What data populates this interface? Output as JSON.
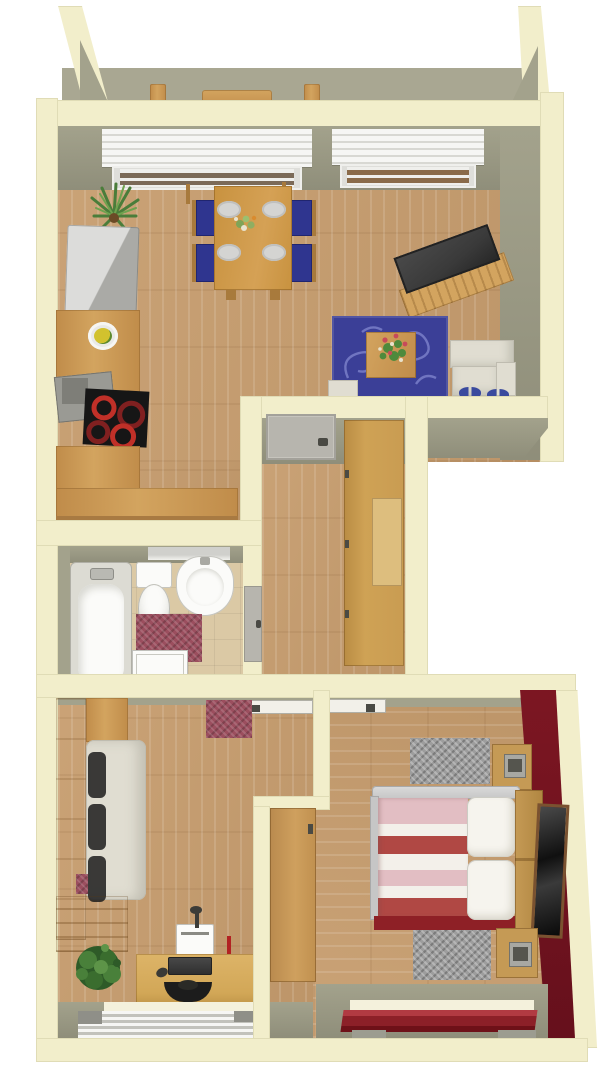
{
  "scene": {
    "type": "3d-floorplan-render",
    "description": "Top-down 3D rendering of a one-bedroom apartment with balcony, open living/dining/kitchen, hallway, bathroom, office room and bedroom",
    "background": "#ffffff"
  },
  "colors": {
    "wall_outer": "#f2eecb",
    "wall_edge": "#d9d3ab",
    "wall_face": "#a3a28c",
    "wall_face_dark": "#8f8e7a",
    "floor_wood": "#c79d6e",
    "floor_bath": "#dbc9a5",
    "floor_balcony": "#a9a792",
    "navy": "#2f358f",
    "rug_blue": "#3b3f97",
    "rug_swirl": "#7a7fc9",
    "table_wood": "#c8923f",
    "chair_wood": "#a87a3c",
    "unit_wood": "#c08c4a",
    "unit_wood_light": "#d3a45f",
    "tv_dark": "#3a3a3a",
    "sofa_white": "#e0ddd1",
    "sofa_line": "#bfbcb0",
    "fridge_light": "#dcdcda",
    "fridge_dark": "#aaaaa6",
    "stove_black": "#161616",
    "burner_red": "#c03028",
    "burner_dark": "#802020",
    "hood_gray": "#9a9a94",
    "hood_dark": "#7e7e78",
    "wardrobe_wood": "#c99c52",
    "wardrobe_inset": "#ddbe7e",
    "door_gray": "#b7b5ae",
    "door_white": "#f2f0e9",
    "handle_dark": "#4a4a44",
    "tub_shell": "#dcdbd3",
    "fixture_white": "#fbfbf9",
    "fixture_shade": "#d8d8d2",
    "rug_maroon": "#9b4e5e",
    "bed_frame": "#c6c6c6",
    "bed_pink": "#e2bec3",
    "bed_red": "#b04844",
    "bed_white": "#f3f0ea",
    "bed_skirt": "#8e2026",
    "pillow_white": "#f6f4ee",
    "pillow_shade": "#d9d6cb",
    "wall_red": "#7c1622",
    "wall_red_dark": "#66101c",
    "rug_gray": "#9d9d9d",
    "night_wood": "#c59a55",
    "clock_gray": "#a8a8a2",
    "clock_face": "#55554e",
    "mirror_frame": "#7a5230",
    "mirror_glass": "#1c1c1c",
    "shelf_red": "#8c2028",
    "shelf_red_light": "#b13a42",
    "desk_wood": "#d2a757",
    "monitor_dark": "#2e2e2e",
    "chair_black": "#1c1c1c",
    "device_white": "#f4f4f0",
    "plant_green": "#4a7d3a",
    "plant_dark": "#2e5b28",
    "plant_light": "#6fa24f",
    "blind_light": "#e8e8e4",
    "blind_gray": "#c2c2bc",
    "blind_cap": "#8f8f88",
    "slipper_blue": "#3a4a9e",
    "window_white": "#f6f6f4",
    "glass_brown": "#7b6a58",
    "sill_white": "#f4f1dc",
    "shadow_gray": "#9c9c90",
    "counter_front": "#a87a42"
  },
  "rooms": [
    {
      "name": "balcony",
      "items": [
        "outdoor-table",
        "outdoor-chair",
        "outdoor-chair"
      ]
    },
    {
      "name": "living-dining-kitchen",
      "items": [
        "fridge",
        "kitchen-counter",
        "fruit-bowl",
        "range-hood",
        "stove",
        "dining-table",
        "dining-chair x4",
        "plate x4",
        "tv-sideboard",
        "tv",
        "area-rug",
        "coffee-table",
        "flower-vase",
        "sofa",
        "slippers x2",
        "side-table",
        "plant",
        "window x2"
      ]
    },
    {
      "name": "hallway",
      "items": [
        "entry-door",
        "wardrobe",
        "bathroom-door"
      ]
    },
    {
      "name": "bathroom",
      "items": [
        "bathtub",
        "toilet",
        "sink",
        "bath-rug",
        "washing-machine",
        "window"
      ]
    },
    {
      "name": "office-room",
      "items": [
        "daybed",
        "cushion-red",
        "pillow x3",
        "side-board",
        "dresser",
        "desk",
        "monitor",
        "printer",
        "desk-lamp",
        "desk-chair",
        "mouse",
        "plant",
        "window",
        "door"
      ]
    },
    {
      "name": "bedroom",
      "items": [
        "double-bed",
        "striped-duvet",
        "pillow x2",
        "nightstand x2",
        "clock-radio x2",
        "rug x2",
        "mirror",
        "accent-wall-red",
        "wall-shelf",
        "door",
        "window"
      ]
    }
  ],
  "counts": {
    "dining_chairs": 4,
    "plates": 4,
    "bed_pillows": 2,
    "daybed_pillows": 3,
    "stove_burners": 4
  }
}
